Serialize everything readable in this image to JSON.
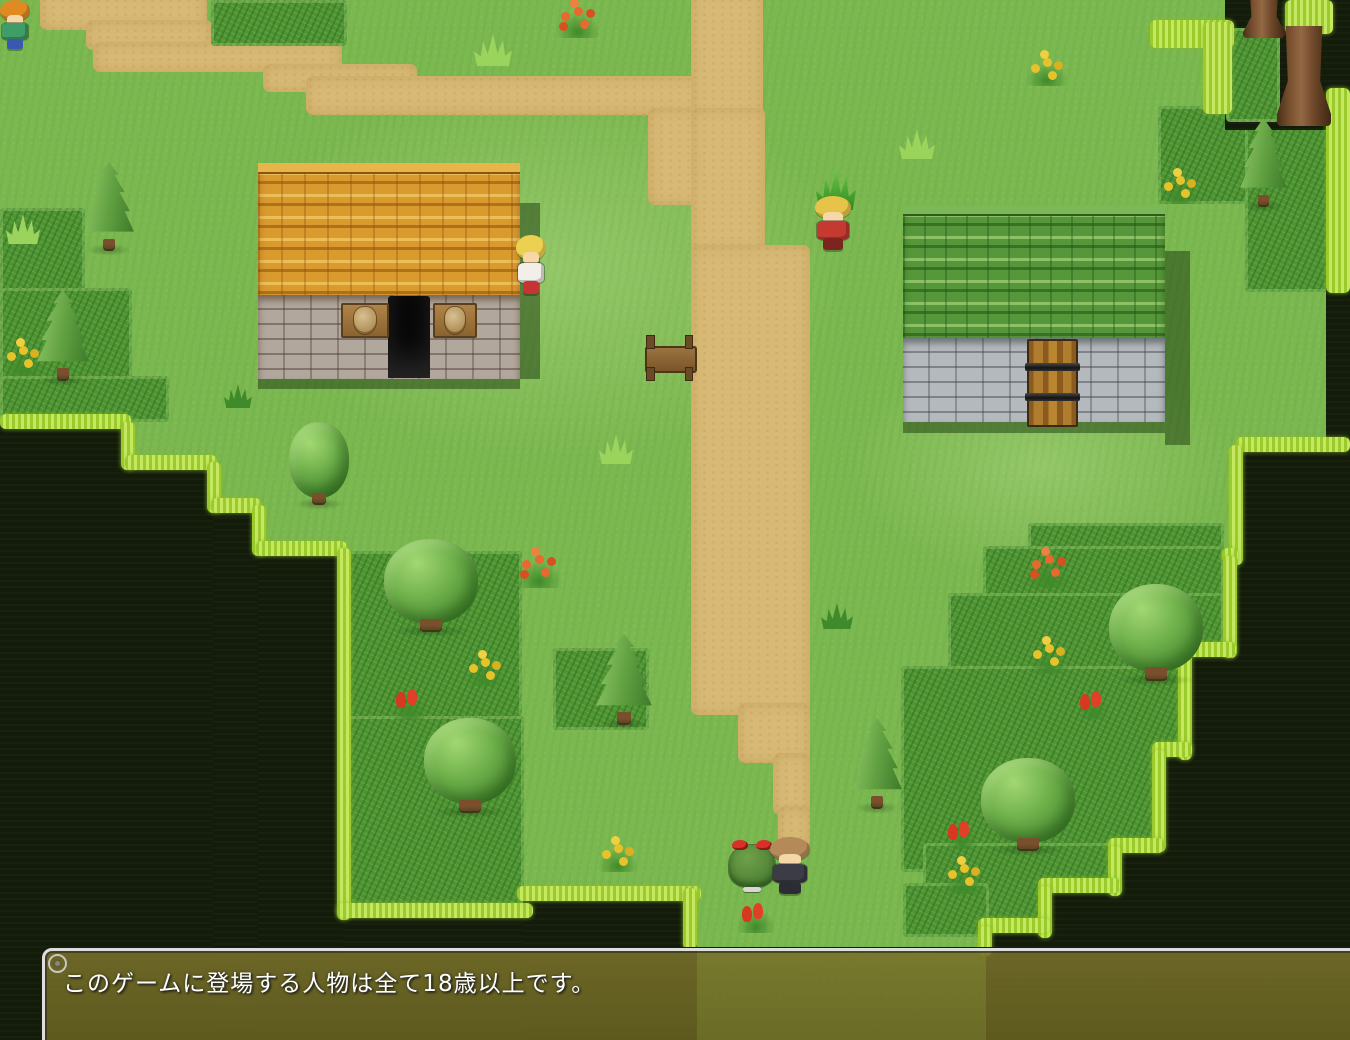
{
  "palette": {
    "grass": "#7cb850",
    "path": "#d8ba76",
    "bush_grass": "#4f9434",
    "edge_fringe": "#a8d43e",
    "void": "#131b0b",
    "roof_left": "#d99a2e",
    "roof_right": "#55973a",
    "window_bg": "#716b26",
    "window_frame": "#dedede",
    "message_text_color": "#ffffff"
  },
  "message_window": {
    "text": "このゲームに登場する人物は全て18歳以上です。",
    "x": 42,
    "y": 948
  },
  "map": {
    "tiles": [
      {
        "t": "light",
        "x": 250,
        "y": 80,
        "w": 600,
        "h": 380
      },
      {
        "t": "light",
        "x": 850,
        "y": 350,
        "w": 380,
        "h": 230
      },
      {
        "t": "path",
        "x": 40,
        "y": -10,
        "w": 167,
        "h": 40
      },
      {
        "t": "path",
        "x": 86,
        "y": 20,
        "w": 126,
        "h": 30
      },
      {
        "t": "path",
        "x": 93,
        "y": 42,
        "w": 249,
        "h": 30
      },
      {
        "t": "path",
        "x": 263,
        "y": 64,
        "w": 154,
        "h": 28
      },
      {
        "t": "path",
        "x": 306,
        "y": 76,
        "w": 404,
        "h": 39
      },
      {
        "t": "path",
        "x": 691,
        "y": -10,
        "w": 72,
        "h": 130
      },
      {
        "t": "path",
        "x": 648,
        "y": 108,
        "w": 117,
        "h": 97
      },
      {
        "t": "path",
        "x": 691,
        "y": 108,
        "w": 74,
        "h": 145
      },
      {
        "t": "path",
        "x": 691,
        "y": 245,
        "w": 119,
        "h": 470
      },
      {
        "t": "path",
        "x": 738,
        "y": 703,
        "w": 72,
        "h": 60
      },
      {
        "t": "path",
        "x": 773,
        "y": 753,
        "w": 37,
        "h": 62
      },
      {
        "t": "path",
        "x": 778,
        "y": 806,
        "w": 32,
        "h": 42
      },
      {
        "t": "bush",
        "x": 0,
        "y": 208,
        "w": 85,
        "h": 214
      },
      {
        "t": "bush",
        "x": 0,
        "y": 288,
        "w": 132,
        "h": 134
      },
      {
        "t": "bush",
        "x": 0,
        "y": 376,
        "w": 169,
        "h": 46
      },
      {
        "t": "bush",
        "x": 211,
        "y": 0,
        "w": 136,
        "h": 46
      },
      {
        "t": "bush",
        "x": 1158,
        "y": 106,
        "w": 172,
        "h": 98
      },
      {
        "t": "bush",
        "x": 1245,
        "y": 106,
        "w": 84,
        "h": 186
      },
      {
        "t": "bush",
        "x": 343,
        "y": 551,
        "w": 179,
        "h": 174
      },
      {
        "t": "bush",
        "x": 553,
        "y": 648,
        "w": 96,
        "h": 82
      },
      {
        "t": "bush",
        "x": 343,
        "y": 716,
        "w": 181,
        "h": 196
      },
      {
        "t": "bush",
        "x": 1028,
        "y": 523,
        "w": 196,
        "h": 76
      },
      {
        "t": "bush",
        "x": 983,
        "y": 546,
        "w": 241,
        "h": 126
      },
      {
        "t": "bush",
        "x": 948,
        "y": 593,
        "w": 276,
        "h": 156
      },
      {
        "t": "bush",
        "x": 901,
        "y": 666,
        "w": 286,
        "h": 206
      },
      {
        "t": "bush",
        "x": 923,
        "y": 843,
        "w": 222,
        "h": 92
      },
      {
        "t": "bush",
        "x": 903,
        "y": 883,
        "w": 86,
        "h": 54
      },
      {
        "t": "void",
        "x": -20,
        "y": 422,
        "w": 149,
        "h": 640
      },
      {
        "t": "void",
        "x": 125,
        "y": 462,
        "w": 92,
        "h": 600
      },
      {
        "t": "void",
        "x": 213,
        "y": 505,
        "w": 49,
        "h": 560
      },
      {
        "t": "void",
        "x": 258,
        "y": 548,
        "w": 85,
        "h": 520
      },
      {
        "t": "void",
        "x": 343,
        "y": 913,
        "w": 186,
        "h": 150
      },
      {
        "t": "void",
        "x": 523,
        "y": 896,
        "w": 174,
        "h": 150
      },
      {
        "t": "void",
        "x": 1225,
        "y": -20,
        "w": 150,
        "h": 150
      },
      {
        "t": "void",
        "x": 1326,
        "y": 92,
        "w": 46,
        "h": 365
      },
      {
        "t": "void",
        "x": 1238,
        "y": 445,
        "w": 134,
        "h": 125
      },
      {
        "t": "void",
        "x": 1230,
        "y": 556,
        "w": 142,
        "h": 102
      },
      {
        "t": "void",
        "x": 1186,
        "y": 650,
        "w": 186,
        "h": 108
      },
      {
        "t": "void",
        "x": 1160,
        "y": 750,
        "w": 212,
        "h": 102
      },
      {
        "t": "void",
        "x": 1116,
        "y": 846,
        "w": 256,
        "h": 48
      },
      {
        "t": "void",
        "x": 1046,
        "y": 886,
        "w": 326,
        "h": 52
      },
      {
        "t": "void",
        "x": 986,
        "y": 926,
        "w": 386,
        "h": 136
      },
      {
        "t": "bush",
        "x": 1226,
        "y": 28,
        "w": 54,
        "h": 94
      },
      {
        "t": "fringe",
        "x": 0,
        "y": 414,
        "w": 131,
        "h": 15
      },
      {
        "t": "fringe",
        "x": 121,
        "y": 422,
        "w": 14,
        "h": 48
      },
      {
        "t": "fringe",
        "x": 125,
        "y": 455,
        "w": 92,
        "h": 15
      },
      {
        "t": "fringe",
        "x": 207,
        "y": 462,
        "w": 14,
        "h": 51
      },
      {
        "t": "fringe",
        "x": 211,
        "y": 498,
        "w": 50,
        "h": 15
      },
      {
        "t": "fringe",
        "x": 252,
        "y": 505,
        "w": 14,
        "h": 51
      },
      {
        "t": "fringe",
        "x": 256,
        "y": 541,
        "w": 91,
        "h": 15
      },
      {
        "t": "fringe",
        "x": 337,
        "y": 548,
        "w": 14,
        "h": 372
      },
      {
        "t": "fringe",
        "x": 337,
        "y": 903,
        "w": 196,
        "h": 15
      },
      {
        "t": "fringe",
        "x": 517,
        "y": 886,
        "w": 184,
        "h": 15
      },
      {
        "t": "fringe",
        "x": 683,
        "y": 888,
        "w": 14,
        "h": 62
      },
      {
        "t": "fringe",
        "x": 1150,
        "y": 20,
        "w": 84,
        "h": 28
      },
      {
        "t": "fringe",
        "x": 1203,
        "y": 22,
        "w": 29,
        "h": 92
      },
      {
        "t": "fringe",
        "x": 1285,
        "y": 0,
        "w": 48,
        "h": 34
      },
      {
        "t": "fringe",
        "x": 1326,
        "y": 88,
        "w": 24,
        "h": 205
      },
      {
        "t": "fringe",
        "x": 1236,
        "y": 437,
        "w": 114,
        "h": 15
      },
      {
        "t": "fringe",
        "x": 1229,
        "y": 445,
        "w": 14,
        "h": 120
      },
      {
        "t": "fringe",
        "x": 1222,
        "y": 548,
        "w": 16,
        "h": 15
      },
      {
        "t": "fringe",
        "x": 1223,
        "y": 556,
        "w": 14,
        "h": 102
      },
      {
        "t": "fringe",
        "x": 1178,
        "y": 642,
        "w": 58,
        "h": 15
      },
      {
        "t": "fringe",
        "x": 1178,
        "y": 650,
        "w": 14,
        "h": 110
      },
      {
        "t": "fringe",
        "x": 1152,
        "y": 742,
        "w": 40,
        "h": 15
      },
      {
        "t": "fringe",
        "x": 1152,
        "y": 750,
        "w": 14,
        "h": 102
      },
      {
        "t": "fringe",
        "x": 1108,
        "y": 838,
        "w": 56,
        "h": 15
      },
      {
        "t": "fringe",
        "x": 1108,
        "y": 846,
        "w": 14,
        "h": 50
      },
      {
        "t": "fringe",
        "x": 1038,
        "y": 878,
        "w": 82,
        "h": 15
      },
      {
        "t": "fringe",
        "x": 1038,
        "y": 886,
        "w": 14,
        "h": 52
      },
      {
        "t": "fringe",
        "x": 978,
        "y": 918,
        "w": 72,
        "h": 15
      },
      {
        "t": "fringe",
        "x": 978,
        "y": 926,
        "w": 14,
        "h": 30
      }
    ],
    "trees": [
      {
        "t": "conifer",
        "x": 83,
        "y": 162,
        "w": 52,
        "h": 90
      },
      {
        "t": "conifer",
        "x": 36,
        "y": 290,
        "w": 54,
        "h": 92
      },
      {
        "t": "round",
        "x": 289,
        "y": 422,
        "w": 60,
        "h": 84
      },
      {
        "t": "round",
        "x": 384,
        "y": 539,
        "w": 94,
        "h": 94
      },
      {
        "t": "conifer",
        "x": 595,
        "y": 634,
        "w": 58,
        "h": 92
      },
      {
        "t": "round",
        "x": 424,
        "y": 718,
        "w": 92,
        "h": 96
      },
      {
        "t": "conifer",
        "x": 851,
        "y": 718,
        "w": 52,
        "h": 92
      },
      {
        "t": "round",
        "x": 981,
        "y": 758,
        "w": 94,
        "h": 94
      },
      {
        "t": "round",
        "x": 1109,
        "y": 584,
        "w": 94,
        "h": 98
      },
      {
        "t": "conifer",
        "x": 1239,
        "y": 118,
        "w": 49,
        "h": 90
      },
      {
        "t": "trunk",
        "x": 1243,
        "y": -10,
        "w": 42,
        "h": 48
      },
      {
        "t": "trunk",
        "x": 1277,
        "y": 26,
        "w": 54,
        "h": 100
      }
    ],
    "flora": [
      {
        "t": "orange",
        "x": 554,
        "y": -4,
        "w": 48,
        "h": 42
      },
      {
        "t": "tuft",
        "x": 474,
        "y": 34,
        "w": 38,
        "h": 32
      },
      {
        "t": "yellow",
        "x": 1024,
        "y": 48,
        "w": 46,
        "h": 38
      },
      {
        "t": "yellow",
        "x": 1158,
        "y": 166,
        "w": 44,
        "h": 38
      },
      {
        "t": "tuft",
        "x": 899,
        "y": 129,
        "w": 36,
        "h": 30
      },
      {
        "t": "sprout",
        "x": 816,
        "y": 168,
        "w": 40,
        "h": 42
      },
      {
        "t": "tuft",
        "x": 6,
        "y": 214,
        "w": 34,
        "h": 30
      },
      {
        "t": "yellow",
        "x": 0,
        "y": 336,
        "w": 46,
        "h": 40
      },
      {
        "t": "darktuft",
        "x": 224,
        "y": 384,
        "w": 28,
        "h": 24
      },
      {
        "t": "tuft",
        "x": 599,
        "y": 434,
        "w": 34,
        "h": 30
      },
      {
        "t": "orange",
        "x": 514,
        "y": 544,
        "w": 50,
        "h": 44
      },
      {
        "t": "tulip",
        "x": 391,
        "y": 678,
        "w": 38,
        "h": 42
      },
      {
        "t": "yellow",
        "x": 463,
        "y": 648,
        "w": 44,
        "h": 38
      },
      {
        "t": "darktuft",
        "x": 821,
        "y": 603,
        "w": 32,
        "h": 26
      },
      {
        "t": "yellow",
        "x": 596,
        "y": 834,
        "w": 44,
        "h": 38
      },
      {
        "t": "tulip",
        "x": 736,
        "y": 893,
        "w": 40,
        "h": 40
      },
      {
        "t": "orange",
        "x": 1024,
        "y": 544,
        "w": 50,
        "h": 44
      },
      {
        "t": "yellow",
        "x": 1026,
        "y": 634,
        "w": 46,
        "h": 40
      },
      {
        "t": "tulip",
        "x": 1078,
        "y": 681,
        "w": 32,
        "h": 38
      },
      {
        "t": "tulip",
        "x": 946,
        "y": 811,
        "w": 32,
        "h": 38
      },
      {
        "t": "yellow",
        "x": 941,
        "y": 854,
        "w": 46,
        "h": 40
      }
    ],
    "buildings": [
      {
        "id": "item-shop-house",
        "roof": "orange",
        "wall": "stone",
        "x": 258,
        "y": 163,
        "w": 262,
        "roof_h": 132,
        "wall_h": 84,
        "door": {
          "style": "open",
          "x": 388,
          "y": 296,
          "w": 42,
          "h": 82
        },
        "signs": [
          {
            "x": 341,
            "y": 303,
            "w": 44,
            "h": 31
          },
          {
            "x": 433,
            "y": 303,
            "w": 40,
            "h": 31
          }
        ],
        "shadows": [
          {
            "x": 520,
            "y": 203,
            "w": 20,
            "h": 176
          },
          {
            "x": 258,
            "y": 379,
            "w": 262,
            "h": 10
          }
        ]
      },
      {
        "id": "green-roof-house",
        "roof": "green",
        "wall": "stone2",
        "x": 903,
        "y": 205,
        "w": 262,
        "roof_h": 133,
        "wall_h": 84,
        "door": {
          "style": "wood",
          "x": 1027,
          "y": 339,
          "w": 47,
          "h": 84
        },
        "signs": [],
        "shadows": [
          {
            "x": 1165,
            "y": 251,
            "w": 25,
            "h": 194
          },
          {
            "x": 903,
            "y": 422,
            "w": 262,
            "h": 11
          }
        ]
      }
    ],
    "props": [
      {
        "t": "bench",
        "x": 643,
        "y": 334,
        "w": 52,
        "h": 46
      }
    ],
    "characters": [
      {
        "id": "villager-kid",
        "kind": "humanoid",
        "x": -2,
        "y": 0,
        "w": 34,
        "h": 50,
        "hair": "#e08a22",
        "top": "#3f9e68",
        "bottom": "#3a58b2"
      },
      {
        "id": "villager-girl",
        "kind": "humanoid",
        "x": 514,
        "y": 235,
        "w": 34,
        "h": 60,
        "hair": "#ecd052",
        "top": "#f2efe8",
        "bottom": "#c83434"
      },
      {
        "id": "hero-red-armor",
        "kind": "humanoid",
        "x": 812,
        "y": 196,
        "w": 42,
        "h": 55,
        "hair": "#e6c44a",
        "top": "#c43a30",
        "bottom": "#7c241e"
      },
      {
        "id": "bush-creature",
        "kind": "bush",
        "x": 729,
        "y": 840,
        "w": 46,
        "h": 52,
        "body": "#55883a",
        "bow": "#d8302a"
      },
      {
        "id": "knight-npc",
        "kind": "humanoid",
        "x": 767,
        "y": 837,
        "w": 46,
        "h": 58,
        "hair": "#b48a58",
        "top": "#3c3c46",
        "bottom": "#2c2c34"
      }
    ]
  }
}
